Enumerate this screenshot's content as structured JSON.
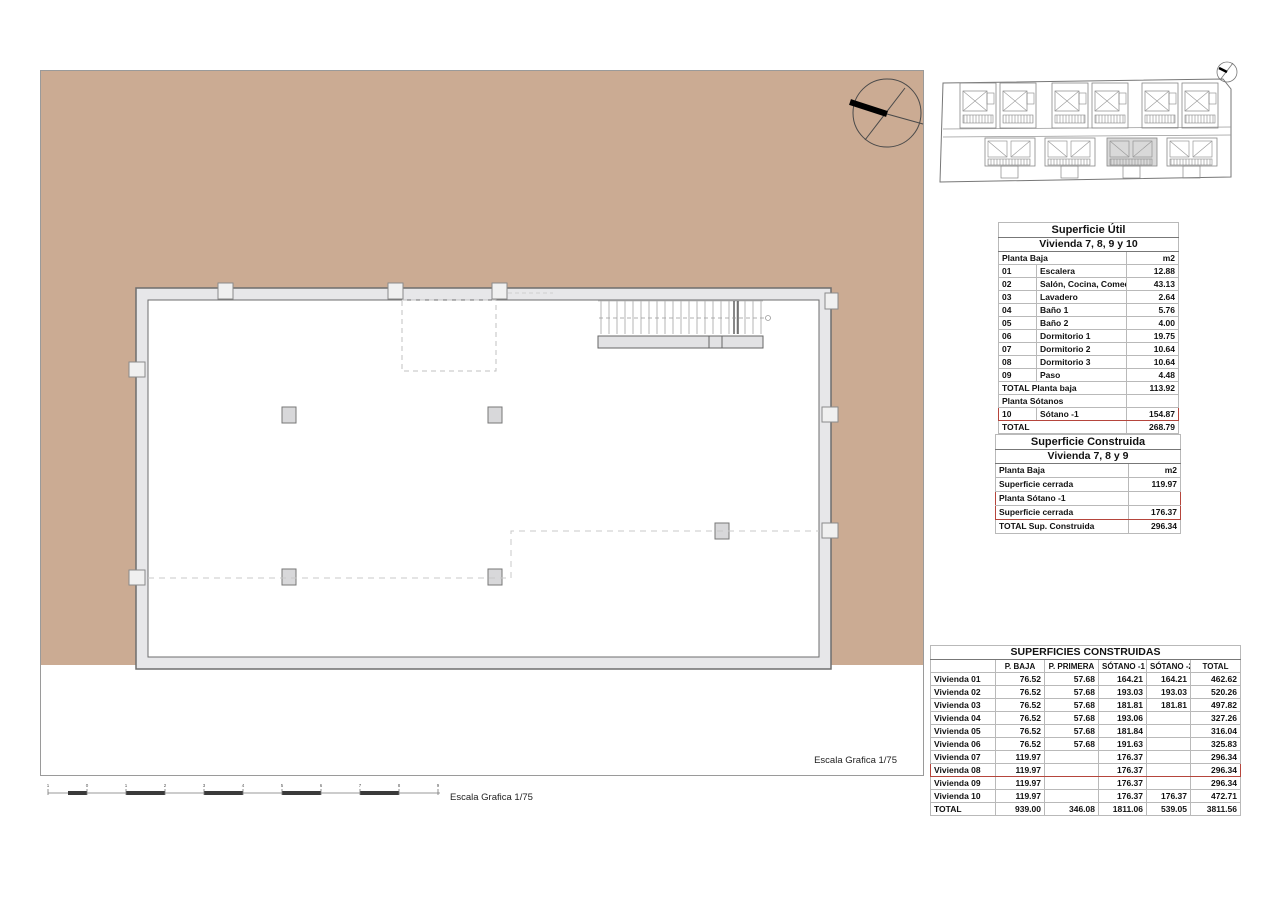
{
  "colors": {
    "tan": "#cbab93",
    "red": "#b5453c",
    "wall_fill": "#e7e7e9",
    "line_gray": "#6e6e6e"
  },
  "labels": {
    "escala_right": "Escala Grafica 1/75",
    "escala_bottom": "Escala Grafica 1/75"
  },
  "scale_bar": {
    "ticks": [
      "1",
      "0",
      "1",
      "2",
      "3",
      "4",
      "5",
      "6",
      "7",
      "8",
      "9"
    ]
  },
  "icons": {
    "north_compass": "north-arrow-circle",
    "site_compass": "north-arrow-circle"
  },
  "superficie_util": {
    "title": "Superficie Útil",
    "subtitle": "Vivienda 7, 8, 9 y 10",
    "rows": [
      {
        "c1": "Planta Baja",
        "c3": "m2",
        "type": "span"
      },
      {
        "c1": "01",
        "c2": "Escalera",
        "c3": "12.88"
      },
      {
        "c1": "02",
        "c2": "Salón, Cocina, Comedor",
        "c3": "43.13"
      },
      {
        "c1": "03",
        "c2": "Lavadero",
        "c3": "2.64"
      },
      {
        "c1": "04",
        "c2": "Baño 1",
        "c3": "5.76"
      },
      {
        "c1": "05",
        "c2": "Baño 2",
        "c3": "4.00"
      },
      {
        "c1": "06",
        "c2": "Dormitorio 1",
        "c3": "19.75"
      },
      {
        "c1": "07",
        "c2": "Dormitorio 2",
        "c3": "10.64"
      },
      {
        "c1": "08",
        "c2": "Dormitorio 3",
        "c3": "10.64"
      },
      {
        "c1": "09",
        "c2": "Paso",
        "c3": "4.48"
      },
      {
        "c1": "TOTAL Planta baja",
        "c3": "113.92",
        "type": "span"
      },
      {
        "c1": "Planta Sótanos",
        "c3": "",
        "type": "span"
      },
      {
        "c1": "10",
        "c2": "Sótano -1",
        "c3": "154.87",
        "highlight": true
      },
      {
        "c1": "TOTAL",
        "c3": "268.79",
        "type": "span"
      }
    ]
  },
  "superficie_construida": {
    "title": "Superficie Construida",
    "subtitle": "Vivienda 7, 8 y 9",
    "rows": [
      {
        "label": "Planta Baja",
        "value": "m2"
      },
      {
        "label": "Superficie cerrada",
        "value": "119.97"
      },
      {
        "label": "Planta Sótano -1",
        "value": "",
        "hl": "top"
      },
      {
        "label": "Superficie cerrada",
        "value": "176.37",
        "hl": "bottom"
      },
      {
        "label": "TOTAL Sup. Construida",
        "value": "296.34"
      }
    ]
  },
  "superficies_construidas": {
    "title": "SUPERFICIES CONSTRUIDAS",
    "columns": [
      "",
      "P. BAJA",
      "P. PRIMERA",
      "SÓTANO -1",
      "SÓTANO -2",
      "TOTAL"
    ],
    "rows": [
      {
        "name": "Vivienda 01",
        "values": [
          "76.52",
          "57.68",
          "164.21",
          "164.21",
          "462.62"
        ]
      },
      {
        "name": "Vivienda 02",
        "values": [
          "76.52",
          "57.68",
          "193.03",
          "193.03",
          "520.26"
        ]
      },
      {
        "name": "Vivienda 03",
        "values": [
          "76.52",
          "57.68",
          "181.81",
          "181.81",
          "497.82"
        ]
      },
      {
        "name": "Vivienda 04",
        "values": [
          "76.52",
          "57.68",
          "193.06",
          "",
          "327.26"
        ]
      },
      {
        "name": "Vivienda 05",
        "values": [
          "76.52",
          "57.68",
          "181.84",
          "",
          "316.04"
        ]
      },
      {
        "name": "Vivienda 06",
        "values": [
          "76.52",
          "57.68",
          "191.63",
          "",
          "325.83"
        ]
      },
      {
        "name": "Vivienda 07",
        "values": [
          "119.97",
          "",
          "176.37",
          "",
          "296.34"
        ]
      },
      {
        "name": "Vivienda 08",
        "values": [
          "119.97",
          "",
          "176.37",
          "",
          "296.34"
        ],
        "highlight": true
      },
      {
        "name": "Vivienda 09",
        "values": [
          "119.97",
          "",
          "176.37",
          "",
          "296.34"
        ]
      },
      {
        "name": "Vivienda 10",
        "values": [
          "119.97",
          "",
          "176.37",
          "176.37",
          "472.71"
        ]
      },
      {
        "name": "TOTAL",
        "values": [
          "939.00",
          "346.08",
          "1811.06",
          "539.05",
          "3811.56"
        ]
      }
    ]
  }
}
